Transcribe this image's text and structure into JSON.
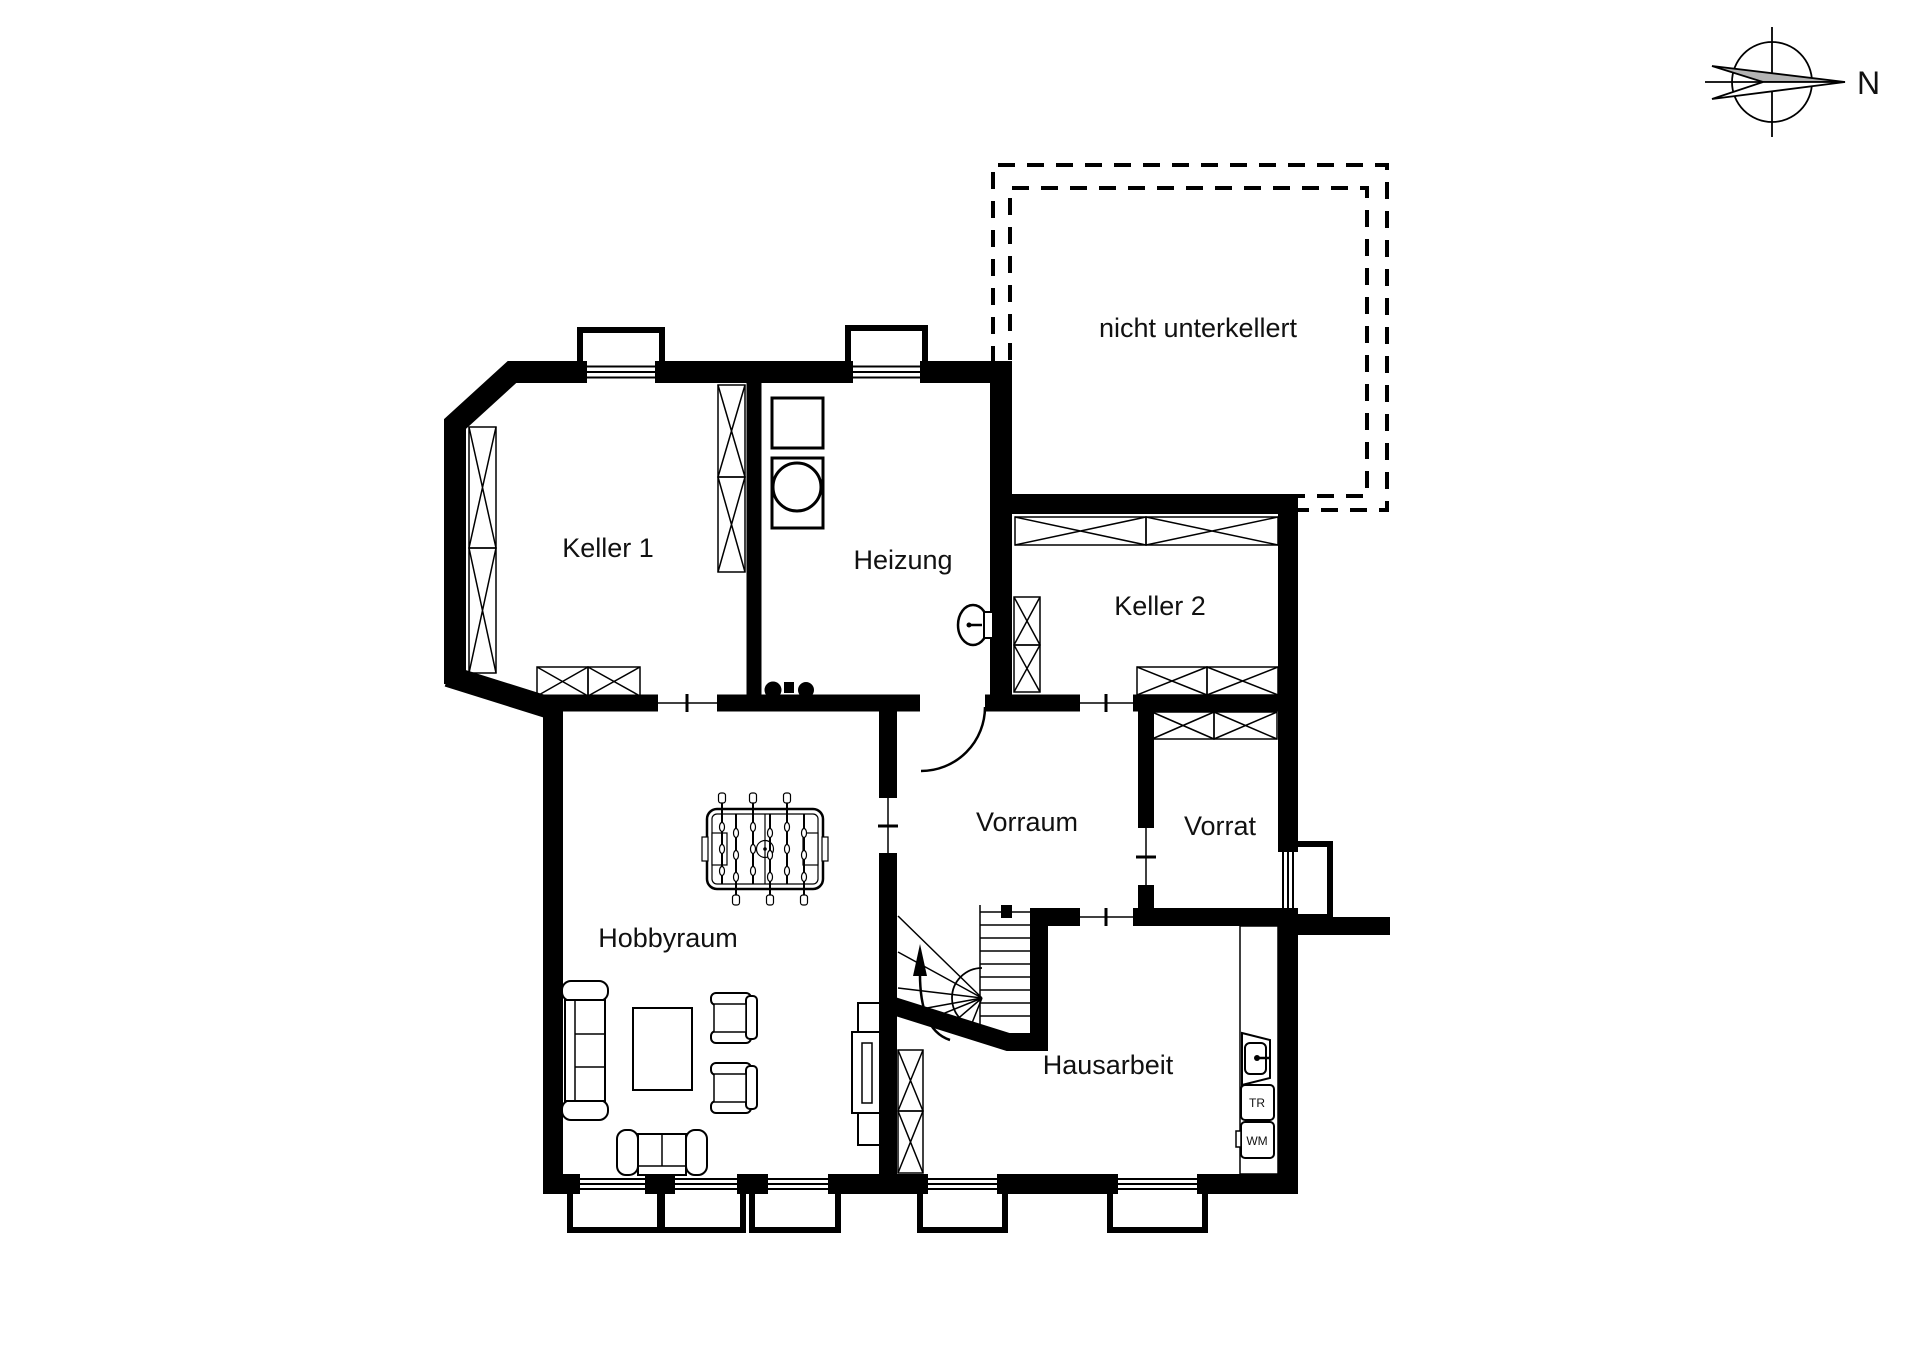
{
  "compass": {
    "north_label": "N"
  },
  "annotation": {
    "nicht_unterkellert": "nicht unterkellert"
  },
  "rooms": {
    "keller1": "Keller 1",
    "heizung": "Heizung",
    "keller2": "Keller 2",
    "vorraum": "Vorraum",
    "vorrat": "Vorrat",
    "hobbyraum": "Hobbyraum",
    "hausarbeit": "Hausarbeit"
  },
  "appliances": {
    "dryer": "TR",
    "washing_machine": "WM"
  },
  "colors": {
    "wall": "#000000",
    "background": "#ffffff",
    "compass_arrow_fill": "#b3b3b3"
  }
}
